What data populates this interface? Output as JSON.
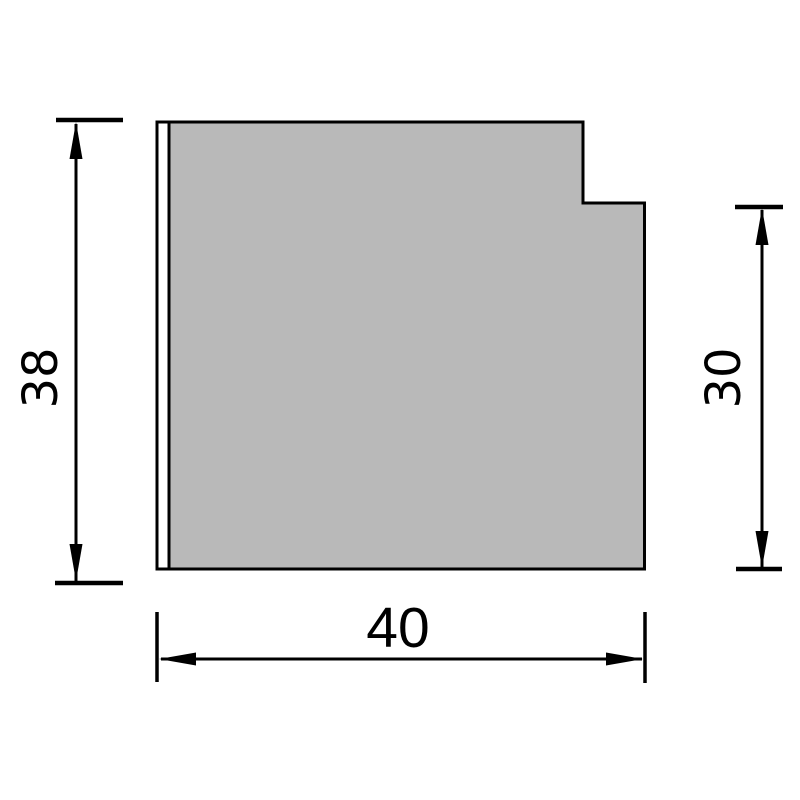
{
  "drawing": {
    "title": "stepped-profile-cross-section",
    "dimensions": {
      "left": {
        "value": "38",
        "orientation": "vertical"
      },
      "right": {
        "value": "30",
        "orientation": "vertical"
      },
      "bottom": {
        "value": "40",
        "orientation": "horizontal"
      }
    },
    "colors": {
      "part_fill": "#b9b9b9",
      "strip_fill": "#ffffff",
      "line": "#000000",
      "background": "#ffffff"
    }
  }
}
